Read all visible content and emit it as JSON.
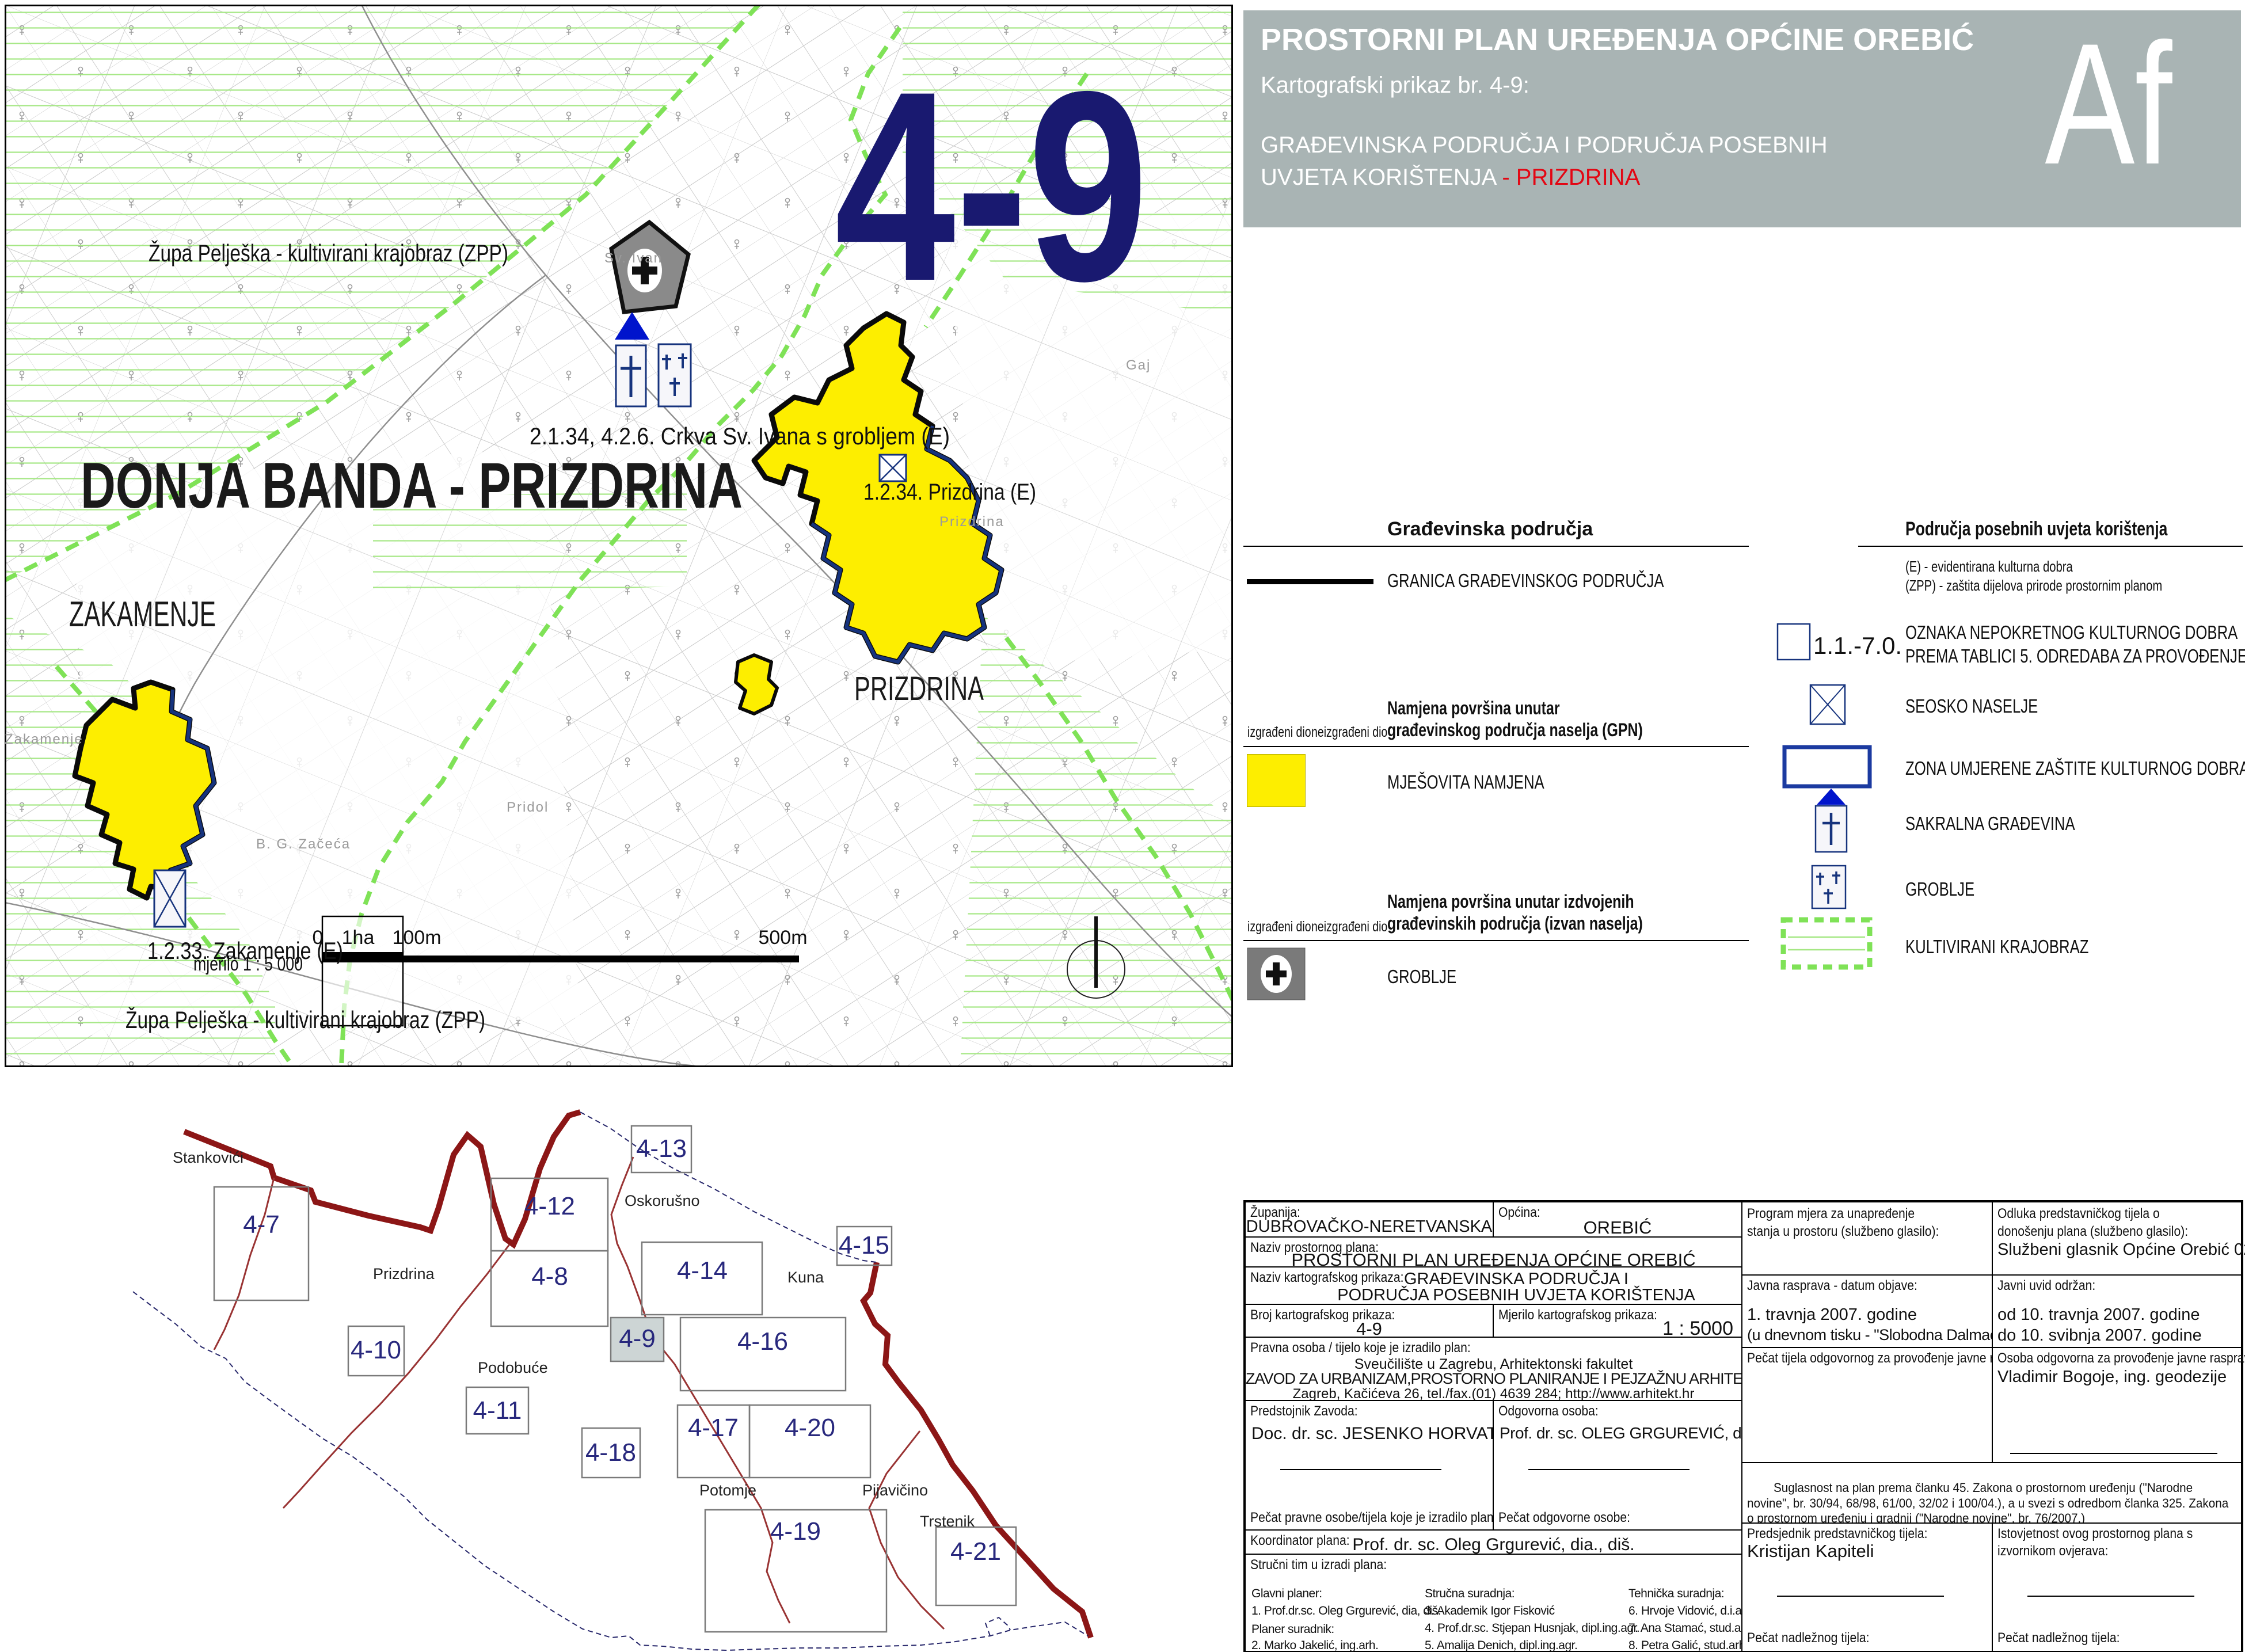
{
  "colors": {
    "navy": "#191970",
    "tile_navy": "#28287d",
    "yellow": "#fdee00",
    "hatch_green": "#a5e784",
    "dash_green": "#7fe257",
    "title_gray": "#a9b4b4",
    "red_accent": "#e30613",
    "boundary_red": "#8c1616",
    "coast_navy": "#27276b"
  },
  "map": {
    "sheet_number": "4-9",
    "area_title": "DONJA BANDA - PRIZDRINA",
    "labels": {
      "zpp_top": "Župa Pelješka - kultivirani krajobraz (ZPP)",
      "church": "2.1.34, 4.2.6. Crkva Sv. Ivana s grobljem (E)",
      "prizdrina_e": "1.2.34. Prizdrina (E)",
      "prizdrina": "PRIZDRINA",
      "zakamenje": "ZAKAMENJE",
      "zakamenje_e": "1.2.33. Zakamenje (E)",
      "zpp_bottom": "Župa Pelješka - kultivirani krajobraz (ZPP)",
      "scale_text": "mjerilo 1 : 5 000",
      "scale_0": "0",
      "scale_1ha": "1ha",
      "scale_100m": "100m",
      "scale_500m": "500m",
      "zakamenje_gray": "Zakamenje",
      "zaceca_gray": "B. G. Začeća",
      "pridol_gray": "Pridol",
      "gaj_gray": "Gaj",
      "sv_ivan_gray": "Sv. Ivan",
      "prizdrina_gray": "Prizdrina"
    }
  },
  "title_block": {
    "title": "PROSTORNI PLAN UREĐENJA OPĆINE OREBIĆ",
    "subtitle": "Kartografski prikaz br. 4-9:",
    "map_name_line1": "GRAĐEVINSKA PODRUČJA I PODRUČJA POSEBNIH",
    "map_name_line2": "UVJETA KORIŠTENJA ",
    "map_name_highlight": "- PRIZDRINA",
    "logo": "Af"
  },
  "legend": {
    "left": {
      "header": "Građevinska područja",
      "granica": "GRANICA GRAĐEVINSKOG PODRUČJA",
      "gpn_line1": "Namjena površina unutar",
      "gpn_line2": "građevinskog područja naselja (GPN)",
      "izgradeni": "izgrađeni dio",
      "neizgradeni": "neizgrađeni dio",
      "mjesovita": "MJEŠOVITA NAMJENA",
      "izdvojena_line1": "Namjena površina unutar izdvojenih",
      "izdvojena_line2": "građevinskih područja (izvan naselja)",
      "izgradeni2": "izgrađeni dio",
      "neizgradeni2": "neizgrađeni dio",
      "groblje": "GROBLJE"
    },
    "right": {
      "header": "Područja posebnih uvjeta korištenja",
      "note_e": "(E) - evidentirana kulturna dobra",
      "note_zpp": "(ZPP) - zaštita dijelova prirode prostornim planom",
      "oznaka_code": "1.1.-7.0.",
      "oznaka_line1": "OZNAKA NEPOKRETNOG KULTURNOG DOBRA",
      "oznaka_line2": "PREMA TABLICI 5. ODREDABA ZA PROVOĐENJE",
      "seosko": "SEOSKO NASELJE",
      "zona": "ZONA UMJERENE ZAŠTITE KULTURNOG DOBRA",
      "sakralna": "SAKRALNA GRAĐEVINA",
      "groblje": "GROBLJE",
      "kultivirani": "KULTIVIRANI KRAJOBRAZ"
    }
  },
  "index_map": {
    "tiles": [
      "4-7",
      "4-12",
      "4-13",
      "4-8",
      "4-14",
      "4-15",
      "4-10",
      "4-9",
      "4-16",
      "4-11",
      "4-17",
      "4-20",
      "4-18",
      "4-19",
      "4-21"
    ],
    "active_tile": "4-9",
    "places": [
      "Stankovići",
      "Oskorušno",
      "Prizdrina",
      "Kuna",
      "Podobuće",
      "Potomje",
      "Pijavičino",
      "Trstenik"
    ]
  },
  "info_table": {
    "zupanija_label": "Županija:",
    "zupanija": "DUBROVAČKO-NERETVANSKA",
    "opcina_label": "Općina:",
    "opcina": "OREBIĆ",
    "naziv_plana_label": "Naziv prostornog plana:",
    "naziv_plana": "PROSTORNI PLAN UREĐENJA OPĆINE OREBIĆ",
    "naziv_prikaza_label": "Naziv kartografskog prikaza:",
    "naziv_prikaza_line1": "GRAĐEVINSKA PODRUČJA I",
    "naziv_prikaza_line2": "PODRUČJA POSEBNIH UVJETA KORIŠTENJA",
    "broj_label": "Broj kartografskog prikaza:",
    "broj": "4-9",
    "mjerilo_label": "Mjerilo kartografskog prikaza:",
    "mjerilo": "1 : 5000",
    "pravna_label": "Pravna osoba / tijelo koje je izradilo plan:",
    "pravna_line1": "Sveučilište u Zagrebu, Arhitektonski fakultet",
    "pravna_line2": "ZAVOD ZA URBANIZAM,PROSTORNO PLANIRANJE I PEJZAŽNU ARHITEKTURU",
    "pravna_line3": "Zagreb, Kačićeva 26, tel./fax.(01) 4639 284; http://www.arhitekt.hr",
    "predstojnik_label": "Predstojnik Zavoda:",
    "predstojnik": "Doc. dr. sc. JESENKO HORVAT, dia.",
    "odgovorna_label": "Odgovorna osoba:",
    "odgovorna": "Prof. dr. sc. OLEG GRGUREVIĆ, dia., diš.",
    "pecat_pravne_label": "Pečat pravne osobe/tijela koje je izradilo plan:",
    "pecat_odgovorne_label": "Pečat odgovorne osobe:",
    "koordinator_label": "Koordinator plana:",
    "koordinator": "Prof. dr. sc. Oleg Grgurević, dia., diš.",
    "strucni_tim_label": "Stručni tim u izradi plana:",
    "glavni_planer_label": "Glavni planer:",
    "glavni_planer": "1. Prof.dr.sc. Oleg Grgurević, dia, diš.",
    "planer_suradnik_label": "Planer suradnik:",
    "planer_suradnik": "2. Marko Jakelić, ing.arh.",
    "strucna_label": "Stručna suradnja:",
    "strucna": [
      "3. Akademik Igor Fisković",
      "4. Prof.dr.sc. Stjepan Husnjak, dipl.ing.agr.",
      "5. Amalija Denich, dipl.ing.agr."
    ],
    "tehnicka_label": "Tehnička suradnja:",
    "tehnicka": [
      "6. Hrvoje Vidović, d.i.a.",
      "7. Ana Stamać, stud.arh.",
      "8. Petra Galić, stud.arh."
    ],
    "program_label": "Program mjera za unapređenje stanja u prostoru (službeno glasilo):",
    "odluka_label": "Odluka predstavničkog tijela o donošenju plana (službeno glasilo):",
    "odluka": "Službeni glasnik Općine Orebić 02/2008.",
    "javna_label": "Javna rasprava - datum objave:",
    "javna_line1": "1. travnja 2007. godine",
    "javna_line2": "(u dnevnom tisku - \"Slobodna Dalmacija\")",
    "uvid_label": "Javni uvid održan:",
    "uvid_line1": "od 10. travnja 2007. godine",
    "uvid_line2": "do 10. svibnja 2007. godine",
    "pecat_tijela_label": "Pečat tijela odgovornog za provođenje javne rasprave:",
    "osoba_label": "Osoba odgovorna za provođenje javne rasprave:",
    "osoba": "Vladimir Bogoje, ing. geodezije",
    "suglasnost_line1": "Suglasnost na plan prema članku 45. Zakona o prostornom uređenju (\"Narodne novine\", br. 30/94, 68/98, 61/00, 32/02 i 100/04.), a u svezi s odredbom članka 325. Zakona o prostornom uređenju i gradnji (\"Narodne novine\", br. 76/2007.)",
    "suglasnost_line2": "MZOPUG,          broj suglasnosti: klasa: 350-02/08-04/03, ur. broj: 531-06-08-4,          od 07. ožujka 2008.",
    "suglasnost_line3": "Upravni odjel DNŽ, broj suglasnosti: klasa: 350-01/08-01/21, ur. broj: 2117/1-09/3-08-2, od 20. veljače 2008.",
    "predsjednik_label": "Predsjednik predstavničkog tijela:",
    "predsjednik": "Kristijan Kapiteli",
    "istovjetnost_label_1": "Istovjetnost ovog prostornog plana s",
    "istovjetnost_label_2": "izvornikom ovjerava:",
    "pecat_nadleznog_label": "Pečat nadležnog tijela:",
    "pecat_nadleznog_label2": "Pečat nadležnog tijela:"
  }
}
